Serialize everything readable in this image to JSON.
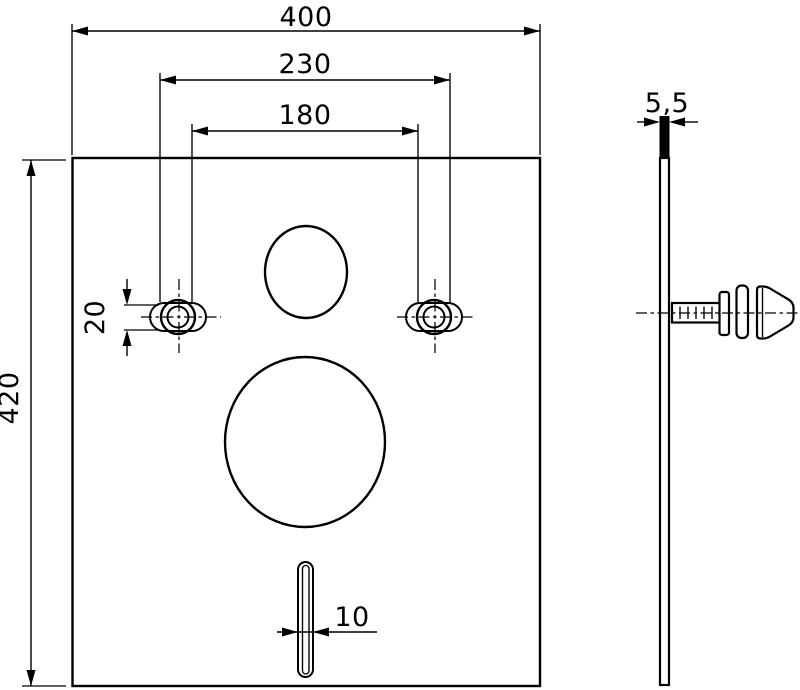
{
  "drawing": {
    "title": "insulation-pad-technical-drawing",
    "background_color": "#ffffff",
    "line_color": "#000000",
    "front_view": {
      "dim_plate_width": "400",
      "dim_hole_spacing_outer": "230",
      "dim_hole_spacing_inner": "180",
      "dim_plate_height": "420",
      "dim_fixing_slot_height": "20",
      "dim_bottom_slot_width": "10"
    },
    "side_view": {
      "dim_thickness": "5,5"
    }
  }
}
